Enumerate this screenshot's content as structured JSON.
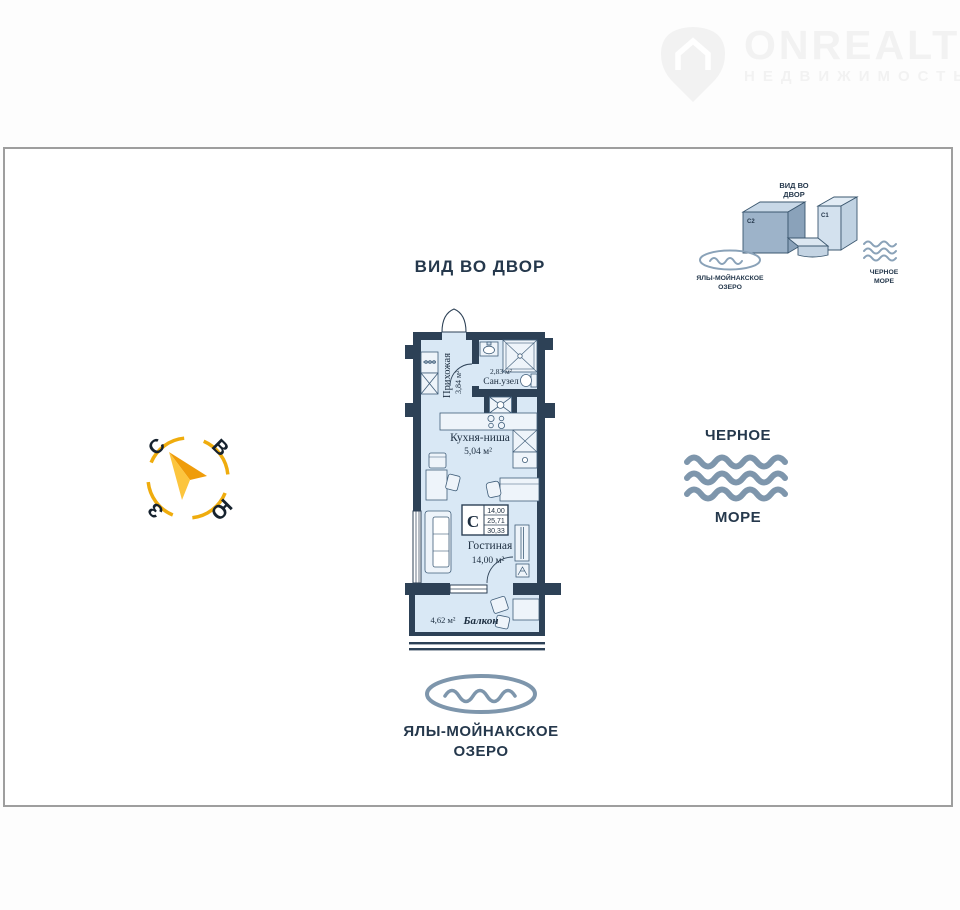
{
  "logo": {
    "brand": "ONREALT",
    "tagline": "НЕДВИЖИМОСТЬ"
  },
  "site_plan": {
    "title_line1": "ВИД ВО",
    "title_line2": "ДВОР",
    "building_left_label": "C2",
    "building_right_label": "C1",
    "lake_line1": "ЯЛЫ-МОЙНАКСКОЕ",
    "lake_line2": "ОЗЕРО",
    "sea_line1": "ЧЕРНОЕ",
    "sea_line2": "МОРЕ"
  },
  "view_label": "ВИД ВО ДВОР",
  "plan": {
    "hallway_name": "Прихожая",
    "hallway_area": "3,84 м²",
    "bath_area": "2,83 м²",
    "bath_name": "Сан.узел",
    "kitchen_name": "Кухня-ниша",
    "kitchen_area": "5,04 м²",
    "living_name": "Гостиная",
    "living_area": "14,00 м²",
    "balcony_area": "4,62 м²",
    "balcony_name": "Балкон",
    "info": {
      "letter": "С",
      "v1": "14,00",
      "v2": "25,71",
      "v3": "30,33"
    }
  },
  "compass": {
    "north": "С",
    "east": "В",
    "south": "Ю",
    "west": "З"
  },
  "sea": {
    "line1": "ЧЕРНОЕ",
    "line2": "МОРЕ"
  },
  "lake": {
    "line1": "ЯЛЫ-МОЙНАКСКОЕ",
    "line2": "ОЗЕРО"
  },
  "colors": {
    "wall": "#2d4156",
    "floor": "#d9e8f5",
    "furniture_stroke": "#3f5d79",
    "label_navy": "#25384c",
    "water": "#7e96ac",
    "compass_yellow": "#efac0d",
    "frame_border": "#9e9e9e",
    "logo_gray": "#f2f2f2"
  }
}
